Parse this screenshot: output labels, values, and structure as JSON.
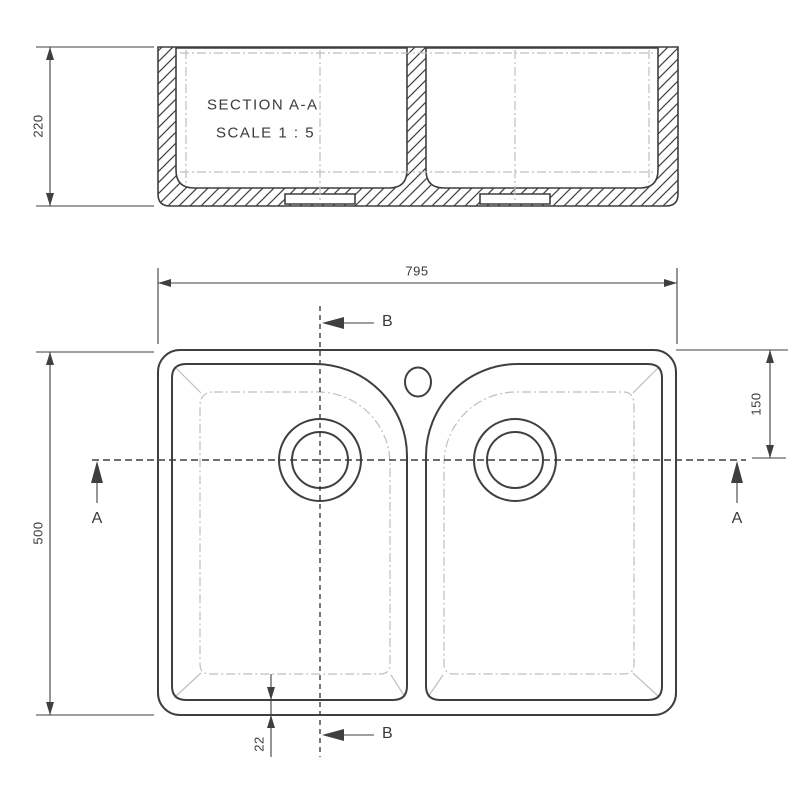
{
  "colors": {
    "line": "#3f3f3f",
    "light": "#bfbfbf",
    "text": "#3a3a3a",
    "background": "#ffffff"
  },
  "drawing": {
    "section": {
      "title": "SECTION A-A",
      "scale": "SCALE 1 : 5"
    },
    "dims": {
      "depth": "220",
      "width": "795",
      "length": "500",
      "drain_offset": "150",
      "rim": "22"
    },
    "markers": {
      "a": "A",
      "b": "B"
    }
  }
}
